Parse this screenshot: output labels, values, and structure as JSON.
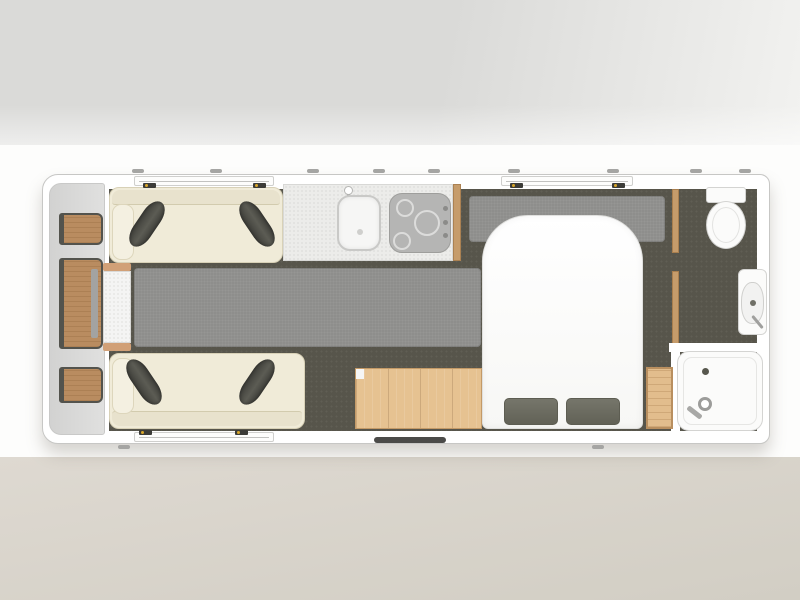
{
  "colors": {
    "band_top_a": "#dadad8",
    "band_top_b": "#f2f2f0",
    "band_mid": "#fdfdfc",
    "band_bot_a": "#ded9d1",
    "band_bot_b": "#d2cec4",
    "body_wall": "#ffffff",
    "body_outline": "#c7c7c5",
    "front_locker_a": "#d2d2d1",
    "front_locker_b": "#e0e0df",
    "floor_dark": "#57554b",
    "carpet": "#8e8e8c",
    "sofa_cream": "#f0ebd8",
    "sofa_back": "#e8e2cd",
    "sofa_arm": "#f4f0e1",
    "sofa_outline": "#d8d1b7",
    "cushion_a": "#3f3f3a",
    "cushion_b": "#5c5c54",
    "wood_front": "#b98c60",
    "wood_front_edge": "#53534d",
    "wood_trim": "#d1a077",
    "wood_wardrobe": "#e6c291",
    "wood_wardrobe_line": "#c49a67",
    "wood_partition": "#c69c6b",
    "wood_cabinet": "#e2bd8d",
    "worktop": "#ececea",
    "hob": "#b5b5b4",
    "hob_ring": "#dcdcdb",
    "fixture": "#fbfbfa",
    "fixture_line": "#d4d4d2",
    "pillow": "#6a6a5e",
    "drain": "#57574d",
    "latch_dark": "#3c3c38",
    "latch_yellow": "#d8a62a",
    "door_bar": "#4b4b49",
    "metal": "#a0a09e"
  },
  "fixtures": [
    "front-storage-shelves",
    "lounge-sofa-top",
    "lounge-sofa-bottom",
    "occasional-chest",
    "carpet-runner-main",
    "carpet-runner-bed-head",
    "kitchen-worktop",
    "kitchen-sink",
    "kitchen-hob",
    "wardrobe",
    "island-bed",
    "bed-pillows",
    "toilet",
    "washbasin",
    "shower-tray",
    "bedside-cabinet",
    "entrance-door",
    "windows"
  ]
}
